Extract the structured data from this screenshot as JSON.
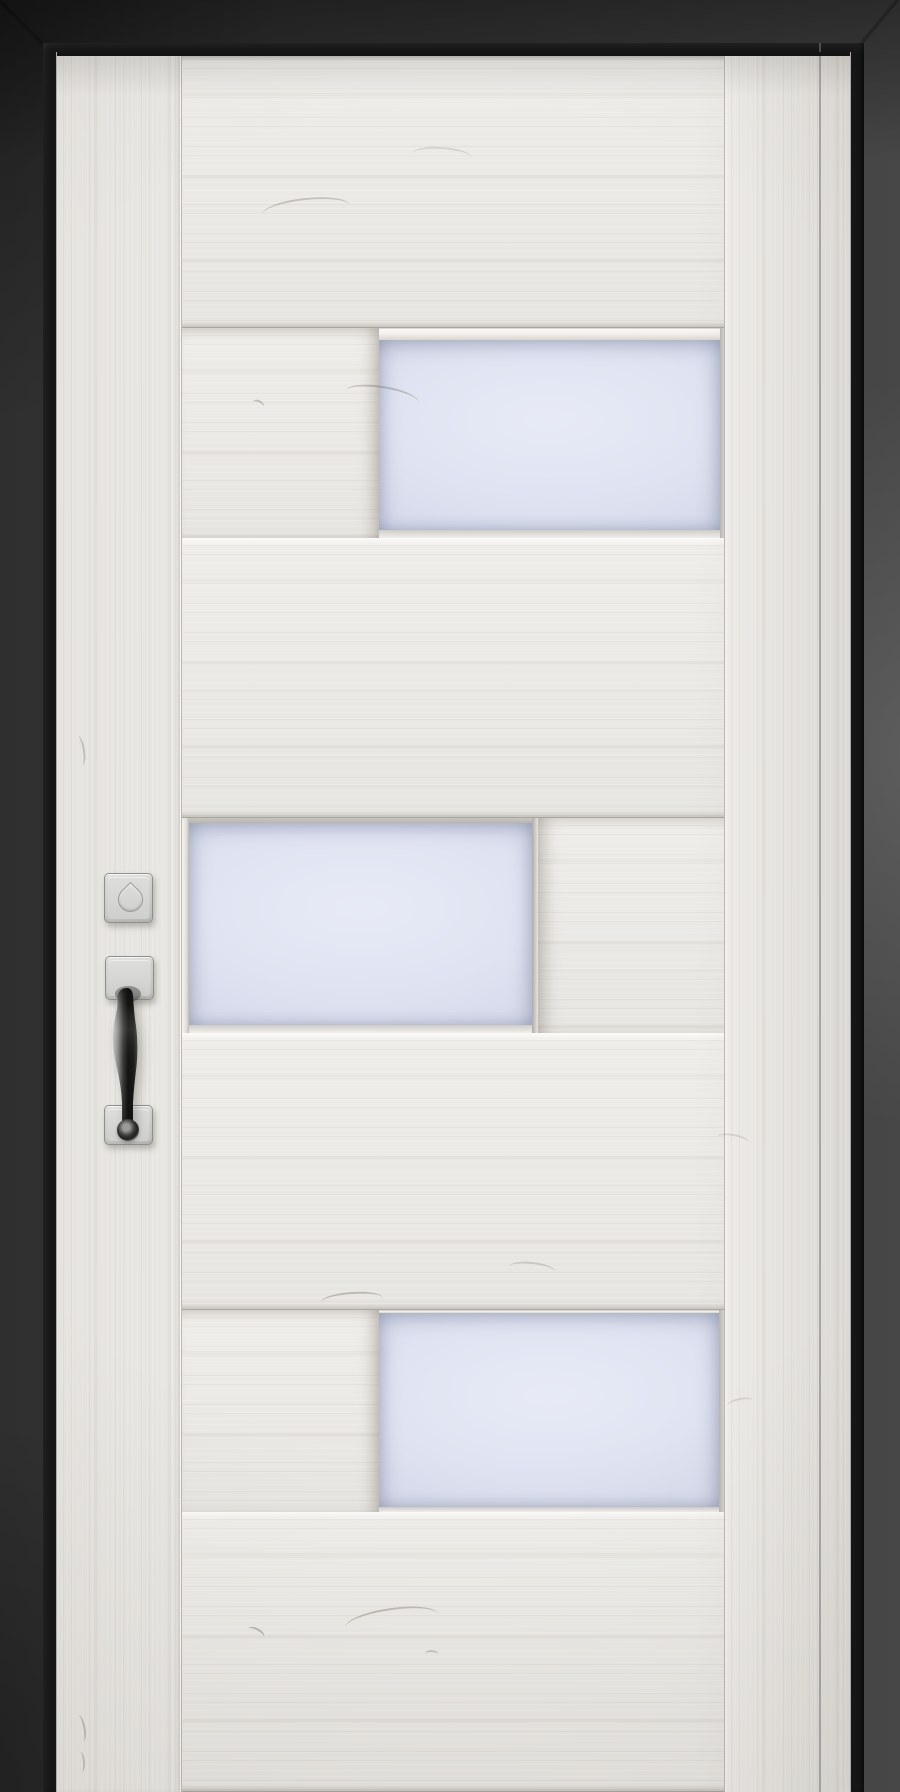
{
  "scene": {
    "description": "Modern interior door in white-washed wood with three offset frosted glass panels, satin nickel pull handle and square deadbolt rosette, set in a dark charcoal frame"
  },
  "colors": {
    "wall_dark": "#2f2f2f",
    "wall_mid": "#3a3a3a",
    "wall_light": "#474747",
    "jamb_black": "#161616",
    "wood_base": "#e7e5e1",
    "wood_hi": "#efede9",
    "glass": "#e7eaf6",
    "glass_edge": "#d4d8e9",
    "hardware_plate": "#d2d2d0",
    "hardware_border": "#90908a",
    "grip_dark": "#141412",
    "grip_light": "#c6c6c4"
  },
  "door": {
    "sections": [
      {
        "name": "plank-1",
        "kind": "plank",
        "height": 276
      },
      {
        "name": "panel-row-1",
        "kind": "glass-right",
        "height": 210,
        "glass": {
          "x": 197,
          "width": 341,
          "top": 12,
          "bottom": 8
        }
      },
      {
        "name": "plank-2",
        "kind": "plank",
        "height": 280
      },
      {
        "name": "panel-row-2",
        "kind": "glass-left",
        "height": 215,
        "glass": {
          "x": 7,
          "width": 343,
          "top": 5,
          "bottom": 8
        }
      },
      {
        "name": "plank-3",
        "kind": "plank",
        "height": 277
      },
      {
        "name": "panel-row-3",
        "kind": "glass-right",
        "height": 202,
        "glass": {
          "x": 197,
          "width": 340,
          "top": 3,
          "bottom": 5
        }
      },
      {
        "name": "plank-4",
        "kind": "plank",
        "height": 280
      }
    ],
    "knots": [
      {
        "x": 205,
        "y": 146,
        "len": 88,
        "arc": 22,
        "rot": -6,
        "opacity": 0.3
      },
      {
        "x": 355,
        "y": 95,
        "len": 60,
        "arc": 16,
        "rot": 4,
        "opacity": 0.18
      },
      {
        "x": 195,
        "y": 348,
        "len": 12,
        "arc": 7,
        "rot": 25,
        "opacity": 0.35
      },
      {
        "x": 288,
        "y": 334,
        "len": 74,
        "arc": 20,
        "rot": 9,
        "opacity": 0.33
      },
      {
        "x": 8,
        "y": 694,
        "len": 30,
        "arc": 8,
        "rot": 82,
        "opacity": 0.3
      },
      {
        "x": 264,
        "y": 1240,
        "len": 62,
        "arc": 14,
        "rot": -4,
        "opacity": 0.35
      },
      {
        "x": 452,
        "y": 1210,
        "len": 46,
        "arc": 12,
        "rot": 6,
        "opacity": 0.25
      },
      {
        "x": 288,
        "y": 1556,
        "len": 94,
        "arc": 24,
        "rot": -8,
        "opacity": 0.35
      },
      {
        "x": 190,
        "y": 1576,
        "len": 18,
        "arc": 8,
        "rot": 28,
        "opacity": 0.4
      },
      {
        "x": 368,
        "y": 1598,
        "len": 13,
        "arc": 6,
        "rot": 2,
        "opacity": 0.3
      },
      {
        "x": 11,
        "y": 1672,
        "len": 26,
        "arc": 7,
        "rot": 80,
        "opacity": 0.35
      },
      {
        "x": 14,
        "y": 1706,
        "len": 20,
        "arc": 6,
        "rot": 86,
        "opacity": 0.3
      },
      {
        "x": 660,
        "y": 1082,
        "len": 32,
        "arc": 10,
        "rot": 10,
        "opacity": 0.2
      },
      {
        "x": 670,
        "y": 1346,
        "len": 26,
        "arc": 9,
        "rot": -12,
        "opacity": 0.18
      }
    ]
  },
  "hardware": {
    "deadbolt": {
      "x": 47,
      "y": 821,
      "w": 49,
      "h": 50
    },
    "top_plate": {
      "x": 48,
      "y": 904,
      "w": 49,
      "h": 44
    },
    "bottom_plate": {
      "x": 47,
      "y": 1053,
      "w": 49,
      "h": 40
    },
    "grip": {
      "x": 50,
      "y": 933,
      "w": 36,
      "h": 150
    },
    "ring": {
      "x": 60,
      "y": 1067,
      "w": 22,
      "h": 22
    }
  }
}
